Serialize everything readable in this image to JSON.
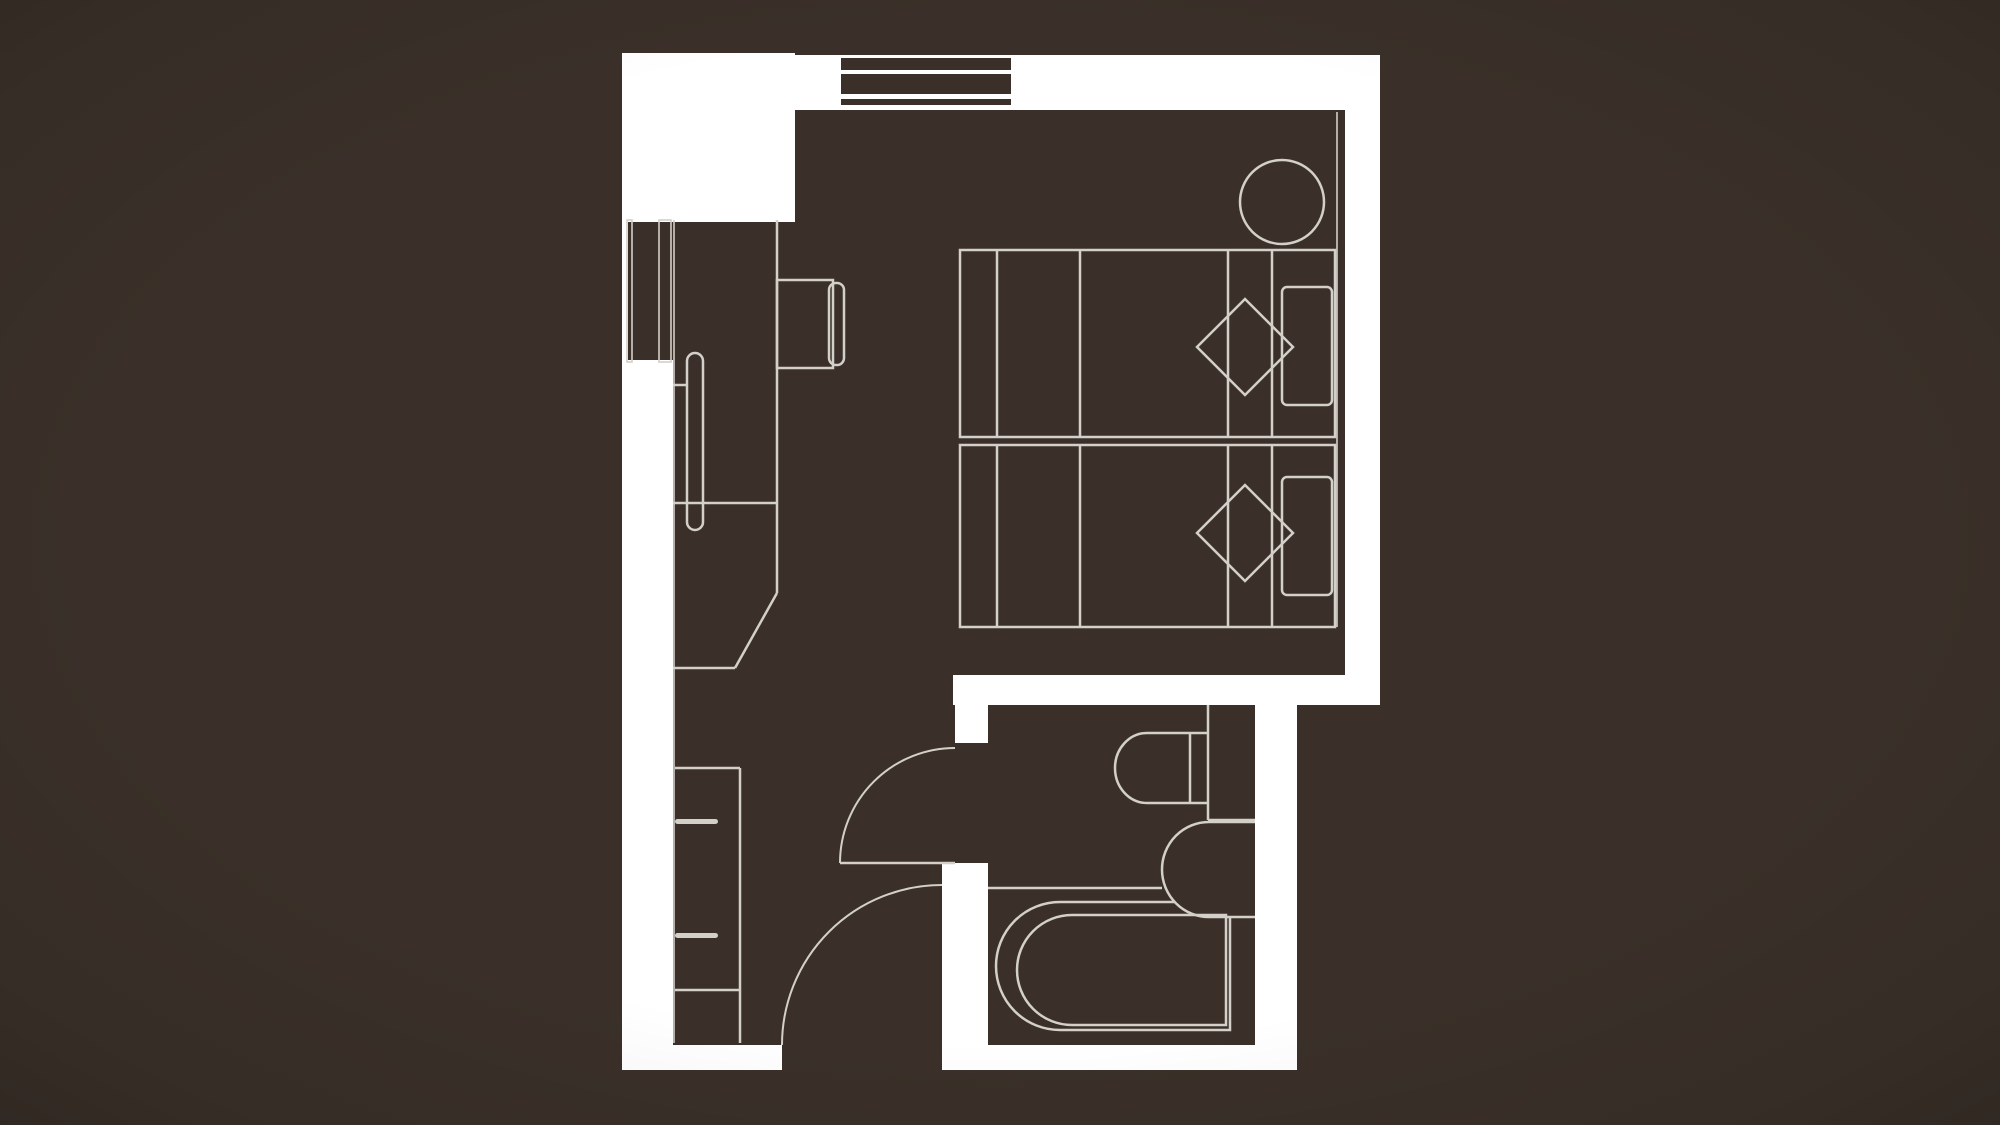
{
  "page": {
    "kind": "architectural-floor-plan",
    "description": "Hotel guest room floor plan: bedroom with two twin beds, round side table, TV console and wardrobe along the left corridor, bathroom at lower right with toilet, vanity sink and bathtub, entry door and bathroom door shown with quarter-circle swings. No text labels are rendered in the drawing.",
    "canvas_width": 2000,
    "canvas_height": 1125
  },
  "colors": {
    "background": "#3a3029",
    "wall": "#ffffff",
    "furniture_line": "#d3cfc9",
    "window_glass": "#3a3029"
  },
  "plan": {
    "rooms": [
      {
        "name": "bedroom",
        "features": [
          "window",
          "twin-bed-upper",
          "twin-bed-lower",
          "diamond-cushion-upper",
          "diamond-cushion-lower",
          "pillow-upper",
          "pillow-lower",
          "round-side-table",
          "tv-console",
          "wardrobe-sliding-door",
          "desk-with-angled-corner"
        ]
      },
      {
        "name": "bathroom",
        "features": [
          "toilet",
          "vanity-sink",
          "bathtub",
          "partition",
          "door-swing"
        ]
      },
      {
        "name": "entry-corridor",
        "features": [
          "closet-shelves",
          "entry-door-swing"
        ]
      }
    ]
  }
}
